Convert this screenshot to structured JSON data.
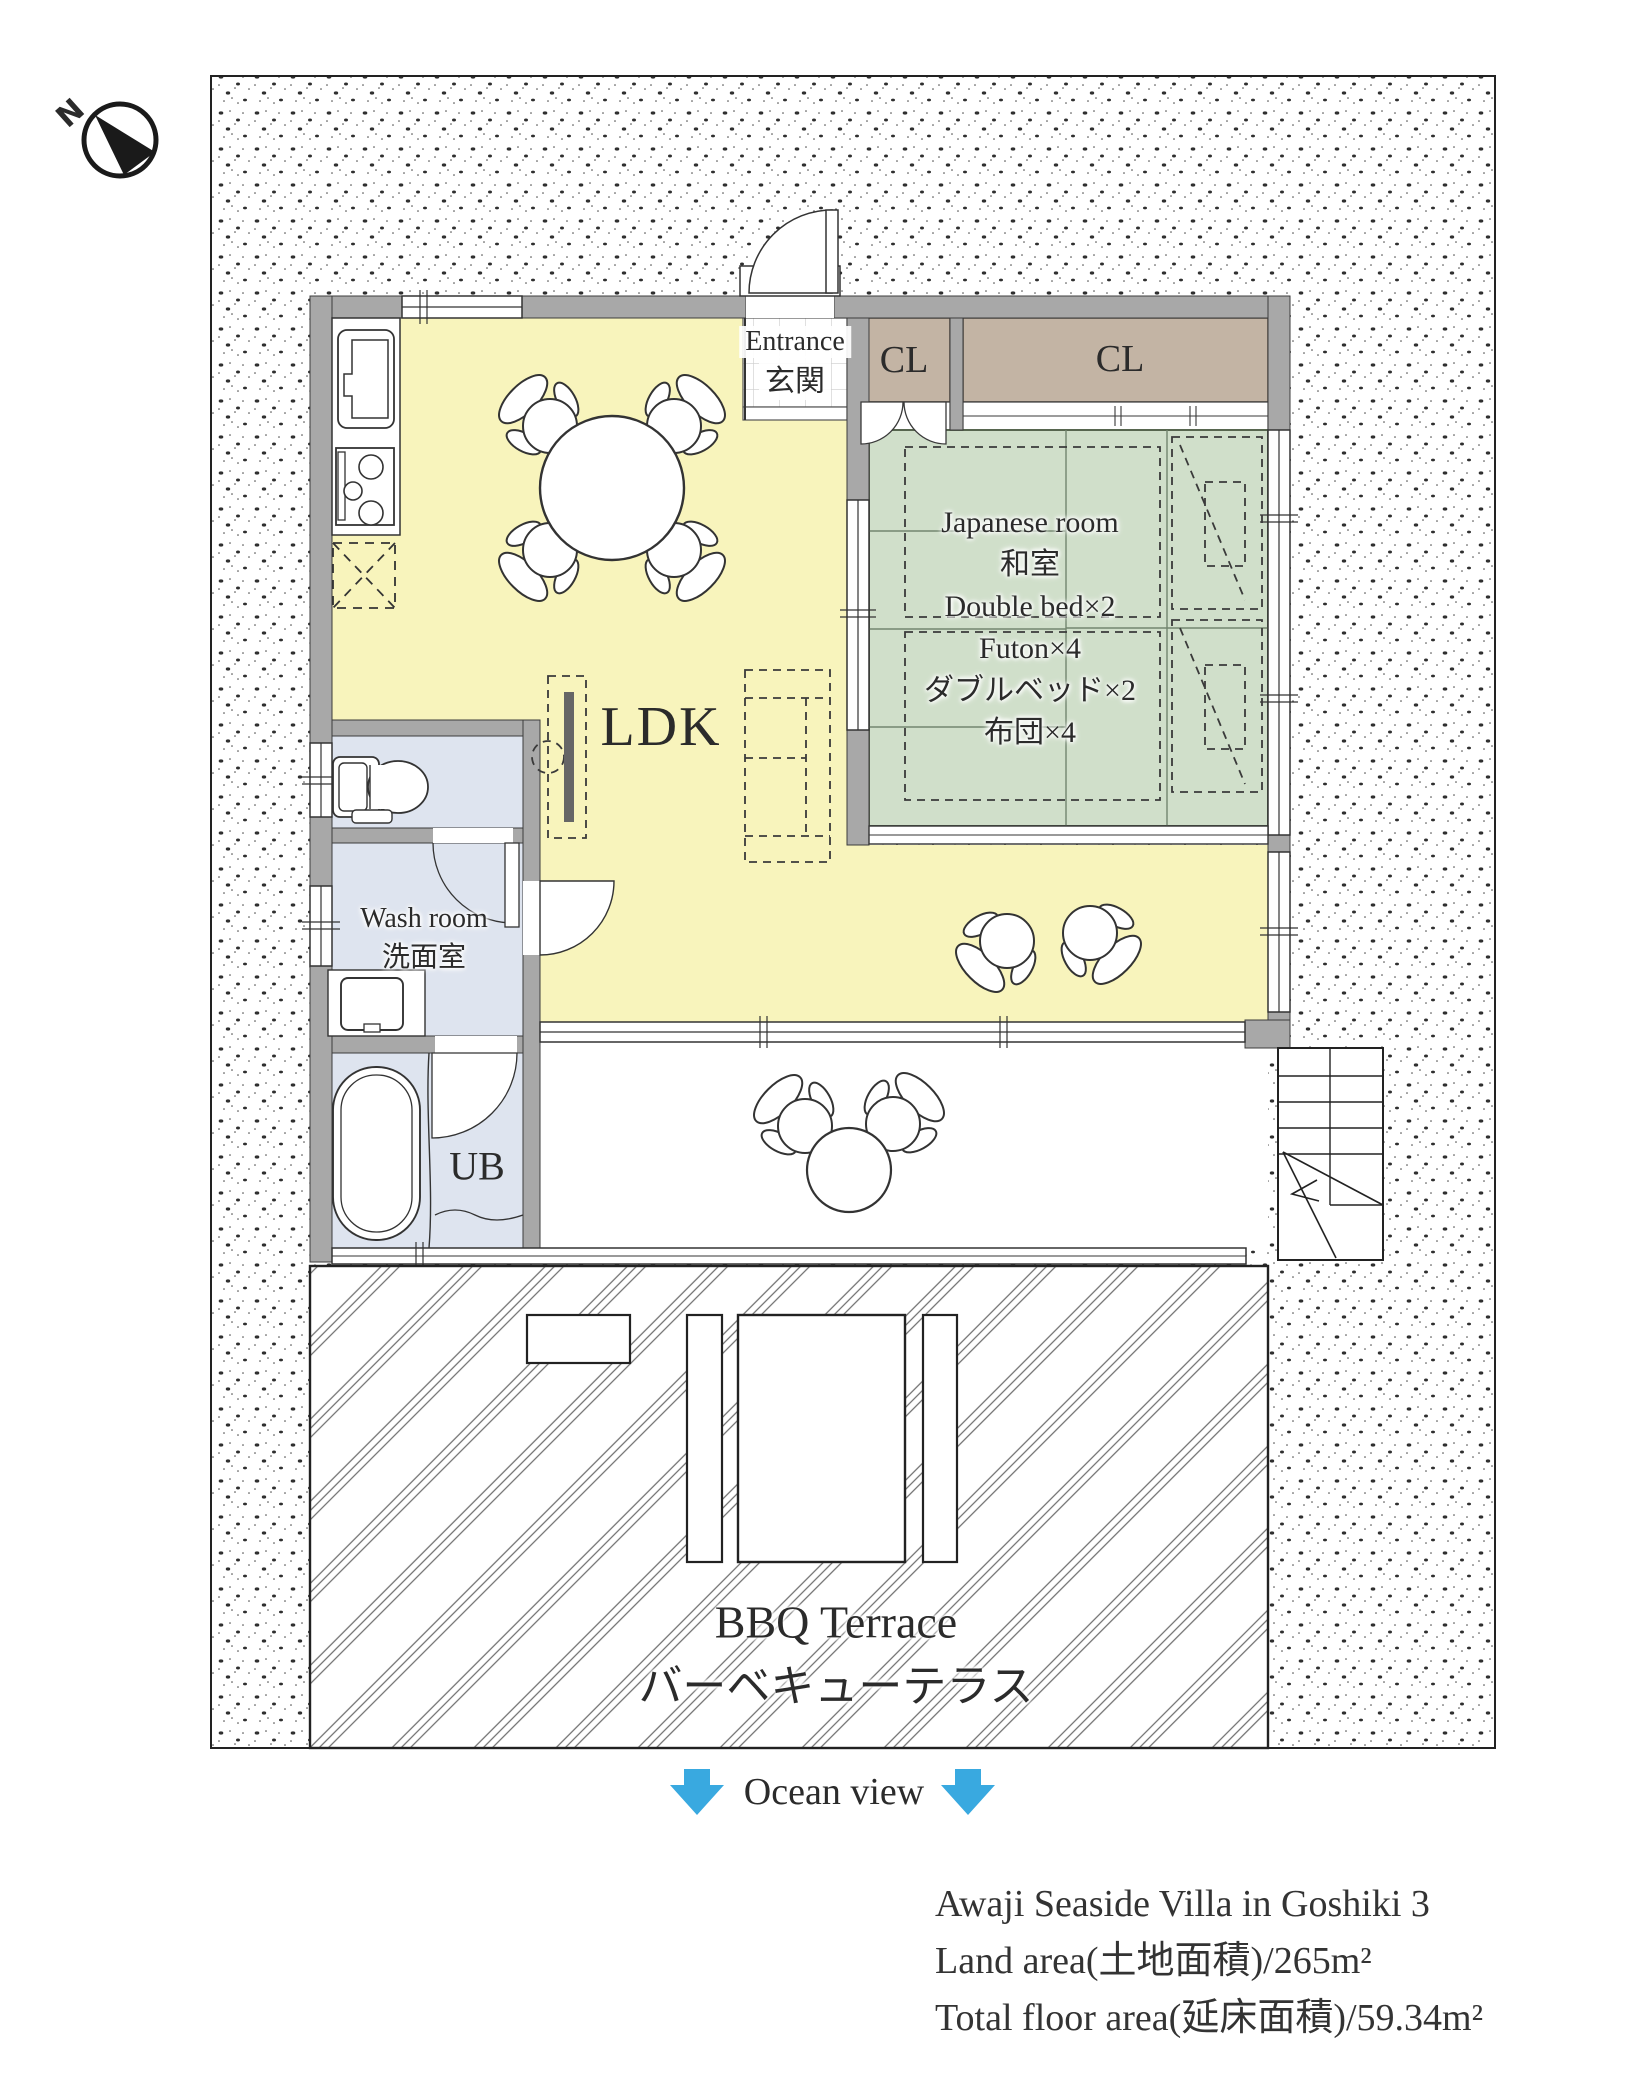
{
  "compass": {
    "north_label": "N"
  },
  "rooms": {
    "ldk": "LDK",
    "entrance": {
      "en": "Entrance",
      "jp": "玄関"
    },
    "closets": [
      "CL",
      "CL"
    ],
    "japanese_room": {
      "lines": [
        "Japanese room",
        "和室",
        "Double bed×2",
        "Futon×4",
        "ダブルベッド×2",
        "布団×4"
      ]
    },
    "wash_room": {
      "en": "Wash room",
      "jp": "洗面室"
    },
    "unit_bath": "UB",
    "bbq_terrace": {
      "en": "BBQ Terrace",
      "jp": "バーベキューテラス"
    }
  },
  "annotations": {
    "ocean_view": "Ocean view"
  },
  "property_info": {
    "lines": [
      "Awaji Seaside Villa in Goshiki 3",
      "Land area(土地面積)/265m²",
      "Total floor area(延床面積)/59.34m²"
    ]
  },
  "colors": {
    "ldk_floor": "#f8f4bc",
    "tatami": "#d0dfca",
    "closet": "#c3b4a4",
    "wet_rooms": "#dee4ef",
    "walls": "#a8a8a8",
    "accent_arrow": "#39a9e0"
  }
}
